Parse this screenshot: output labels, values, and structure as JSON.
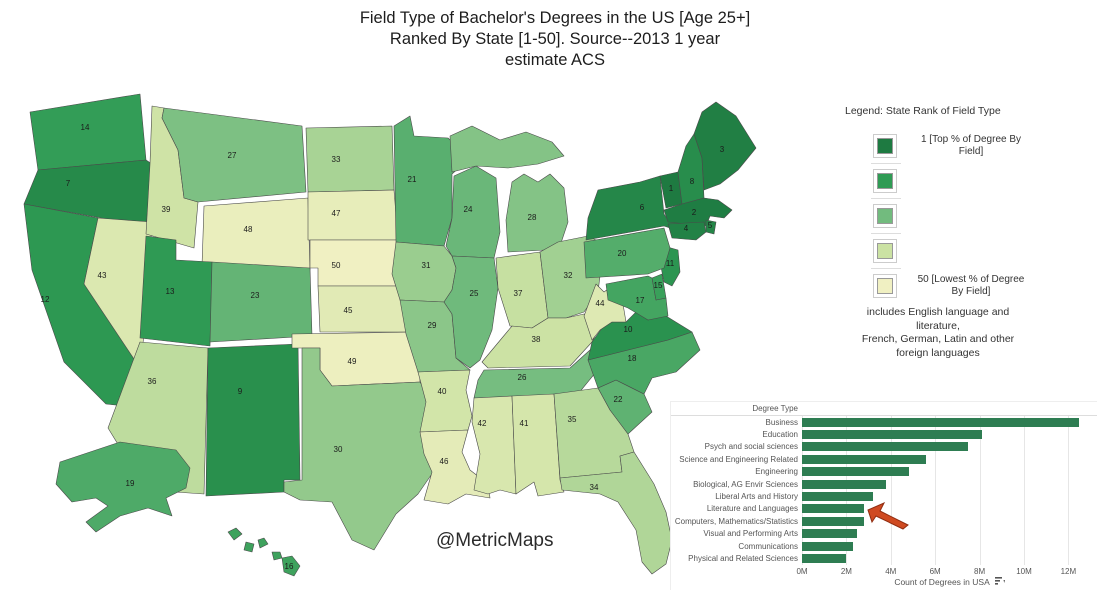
{
  "title": {
    "lines": [
      "Field Type of Bachelor's Degrees in the US [Age 25+]",
      "Ranked By State [1-50].  Source--2013 1 year",
      "estimate ACS"
    ]
  },
  "watermark": "@MetricMaps",
  "legend": {
    "title": "Legend:  State Rank of Field Type",
    "top_label": "1 [Top % of Degree By Field]",
    "bottom_label": "50 [Lowest % of Degree By Field]"
  },
  "note": {
    "lines": [
      "includes English language and",
      "literature,",
      "French, German, Latin and other",
      "foreign languages"
    ]
  },
  "chart_data": [
    {
      "type": "choropleth",
      "title": "State Rank of Field Type",
      "value_field": "rank",
      "scale": {
        "min": 1,
        "max": 50,
        "min_label": "1 [Top % of Degree By Field]",
        "max_label": "50 [Lowest % of Degree By Field]",
        "colors": [
          "#1e7a41",
          "#2f9b54",
          "#72bb7e",
          "#cbe2a3",
          "#f0f0c2"
        ]
      },
      "number_color": "#1b1b1b",
      "states": [
        {
          "abbr": "WA",
          "name": "Washington",
          "rank": 14
        },
        {
          "abbr": "OR",
          "name": "Oregon",
          "rank": 7
        },
        {
          "abbr": "CA",
          "name": "California",
          "rank": 12
        },
        {
          "abbr": "NV",
          "name": "Nevada",
          "rank": 43
        },
        {
          "abbr": "ID",
          "name": "Idaho",
          "rank": 39
        },
        {
          "abbr": "MT",
          "name": "Montana",
          "rank": 27
        },
        {
          "abbr": "WY",
          "name": "Wyoming",
          "rank": 48
        },
        {
          "abbr": "UT",
          "name": "Utah",
          "rank": 13
        },
        {
          "abbr": "CO",
          "name": "Colorado",
          "rank": 23
        },
        {
          "abbr": "AZ",
          "name": "Arizona",
          "rank": 36
        },
        {
          "abbr": "NM",
          "name": "New Mexico",
          "rank": 9
        },
        {
          "abbr": "ND",
          "name": "North Dakota",
          "rank": 33
        },
        {
          "abbr": "SD",
          "name": "South Dakota",
          "rank": 47
        },
        {
          "abbr": "NE",
          "name": "Nebraska",
          "rank": 50
        },
        {
          "abbr": "KS",
          "name": "Kansas",
          "rank": 45
        },
        {
          "abbr": "OK",
          "name": "Oklahoma",
          "rank": 49
        },
        {
          "abbr": "TX",
          "name": "Texas",
          "rank": 30
        },
        {
          "abbr": "MN",
          "name": "Minnesota",
          "rank": 21
        },
        {
          "abbr": "IA",
          "name": "Iowa",
          "rank": 31
        },
        {
          "abbr": "MO",
          "name": "Missouri",
          "rank": 29
        },
        {
          "abbr": "AR",
          "name": "Arkansas",
          "rank": 40
        },
        {
          "abbr": "LA",
          "name": "Louisiana",
          "rank": 46
        },
        {
          "abbr": "WI",
          "name": "Wisconsin",
          "rank": 24
        },
        {
          "abbr": "IL",
          "name": "Illinois",
          "rank": 25
        },
        {
          "abbr": "MI",
          "name": "Michigan",
          "rank": 28
        },
        {
          "abbr": "IN",
          "name": "Indiana",
          "rank": 37
        },
        {
          "abbr": "OH",
          "name": "Ohio",
          "rank": 32
        },
        {
          "abbr": "KY",
          "name": "Kentucky",
          "rank": 38
        },
        {
          "abbr": "TN",
          "name": "Tennessee",
          "rank": 26
        },
        {
          "abbr": "MS",
          "name": "Mississippi",
          "rank": 42
        },
        {
          "abbr": "AL",
          "name": "Alabama",
          "rank": 41
        },
        {
          "abbr": "GA",
          "name": "Georgia",
          "rank": 35
        },
        {
          "abbr": "FL",
          "name": "Florida",
          "rank": 34
        },
        {
          "abbr": "SC",
          "name": "South Carolina",
          "rank": 22
        },
        {
          "abbr": "NC",
          "name": "North Carolina",
          "rank": 18
        },
        {
          "abbr": "VA",
          "name": "Virginia",
          "rank": 10
        },
        {
          "abbr": "WV",
          "name": "West Virginia",
          "rank": 44
        },
        {
          "abbr": "MD",
          "name": "Maryland",
          "rank": 17
        },
        {
          "abbr": "DE",
          "name": "Delaware",
          "rank": 15
        },
        {
          "abbr": "NJ",
          "name": "New Jersey",
          "rank": 11
        },
        {
          "abbr": "PA",
          "name": "Pennsylvania",
          "rank": 20
        },
        {
          "abbr": "NY",
          "name": "New York",
          "rank": 6
        },
        {
          "abbr": "CT",
          "name": "Connecticut",
          "rank": 4
        },
        {
          "abbr": "RI",
          "name": "Rhode Island",
          "rank": 5
        },
        {
          "abbr": "MA",
          "name": "Massachusetts",
          "rank": 2
        },
        {
          "abbr": "VT",
          "name": "Vermont",
          "rank": 1
        },
        {
          "abbr": "NH",
          "name": "New Hampshire",
          "rank": 8
        },
        {
          "abbr": "ME",
          "name": "Maine",
          "rank": 3
        },
        {
          "abbr": "AK",
          "name": "Alaska",
          "rank": 19
        },
        {
          "abbr": "HI",
          "name": "Hawaii",
          "rank": 16
        }
      ]
    },
    {
      "type": "bar",
      "orientation": "horizontal",
      "column_header": "Degree Type",
      "xlabel": "Count of Degrees in USA",
      "categories": [
        "Business",
        "Education",
        "Psych and social sciences",
        "Science and Engineering Related",
        "Engineering",
        "Biological, AG  Envir Sciences",
        "Liberal Arts and History",
        "Literature and Languages",
        "Computers, Mathematics/Statistics",
        "Visual and Performing Arts",
        "Communications",
        "Physical and Related Sciences"
      ],
      "values": [
        12.5,
        8.1,
        7.5,
        5.6,
        4.8,
        3.8,
        3.2,
        2.8,
        2.8,
        2.5,
        2.3,
        2.0
      ],
      "value_unit": "millions of degrees",
      "x_ticks": [
        "0M",
        "2M",
        "4M",
        "6M",
        "8M",
        "10M",
        "12M"
      ],
      "x_tick_values": [
        0,
        2,
        4,
        6,
        8,
        10,
        12
      ],
      "xlim": [
        0,
        13.2
      ],
      "bar_color": "#2e7d52",
      "grid": true,
      "annotation": {
        "type": "arrow",
        "target_category": "Literature and Languages",
        "color": "#cf4a21"
      }
    }
  ]
}
